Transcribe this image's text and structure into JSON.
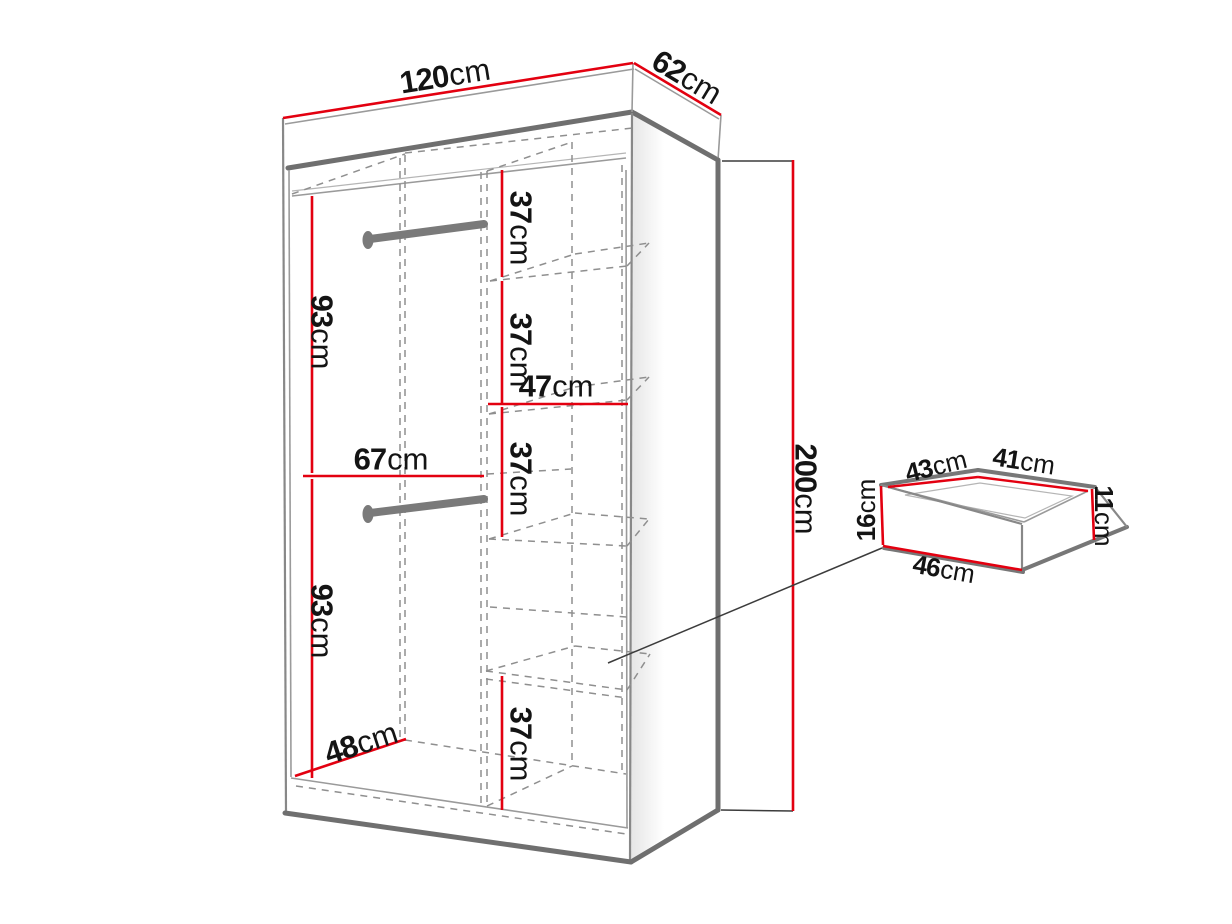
{
  "diagram": {
    "title": "Wardrobe dimension diagram",
    "subject": "Sliding-door wardrobe with shelves, two hanging rails and a drawer detail",
    "accent_color": "#e30010",
    "line_color": "#6f6f6f",
    "unit": "cm"
  },
  "wardrobe": {
    "overall_width": {
      "v": "120",
      "u": "cm"
    },
    "overall_depth": {
      "v": "62",
      "u": "cm"
    },
    "overall_height": {
      "v": "200",
      "u": "cm"
    },
    "interior": {
      "hanging_top_height": {
        "v": "93",
        "u": "cm"
      },
      "hanging_bottom_height": {
        "v": "93",
        "u": "cm"
      },
      "hanging_width": {
        "v": "67",
        "u": "cm"
      },
      "floor_depth": {
        "v": "48",
        "u": "cm"
      },
      "shelf_column_width": {
        "v": "47",
        "u": "cm"
      },
      "shelf_gap_1": {
        "v": "37",
        "u": "cm"
      },
      "shelf_gap_2": {
        "v": "37",
        "u": "cm"
      },
      "shelf_gap_3": {
        "v": "37",
        "u": "cm"
      },
      "shelf_gap_4": {
        "v": "37",
        "u": "cm"
      }
    }
  },
  "drawer": {
    "back_width": {
      "v": "43",
      "u": "cm"
    },
    "side_depth": {
      "v": "41",
      "u": "cm"
    },
    "front_height": {
      "v": "16",
      "u": "cm"
    },
    "inner_height": {
      "v": "11",
      "u": "cm"
    },
    "front_width": {
      "v": "46",
      "u": "cm"
    }
  }
}
